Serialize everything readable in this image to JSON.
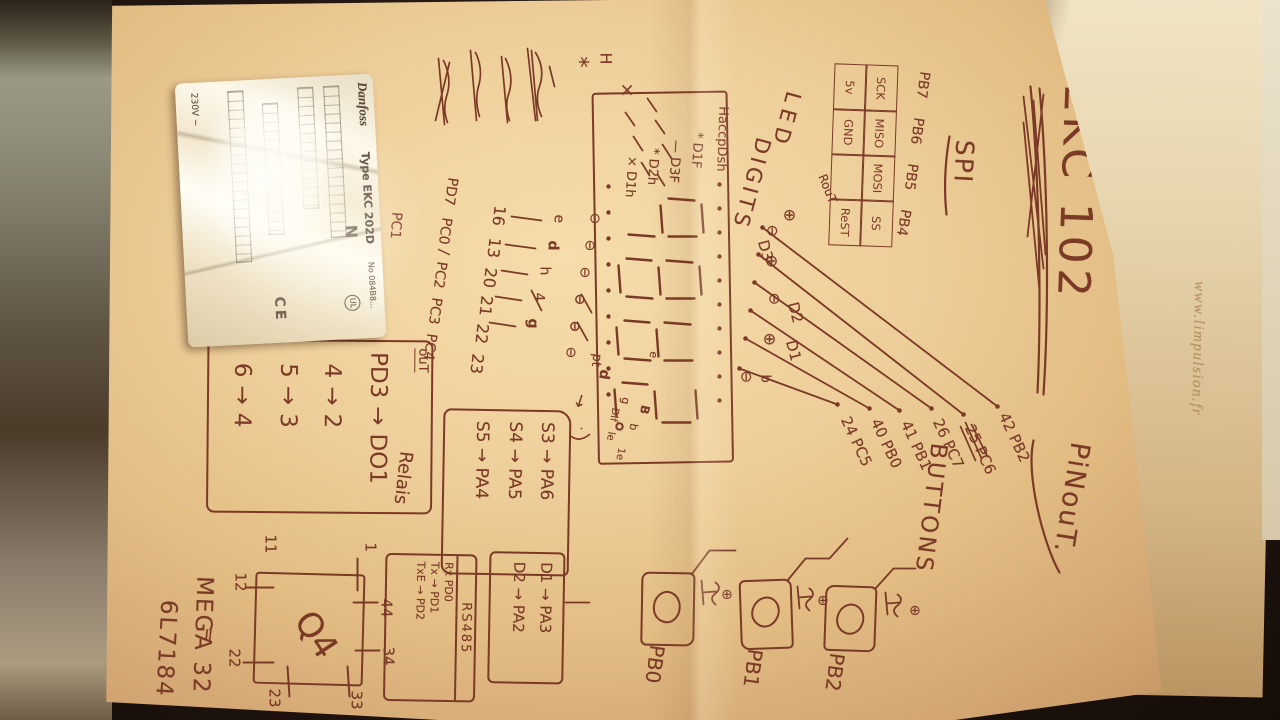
{
  "photo": {
    "watermark": "www.limpulsion.fr"
  },
  "page": {
    "title": "EKC 102",
    "subtitle": "PiNouT.",
    "chip": "MEGA 32",
    "code": "6L7184"
  },
  "icons": {
    "circled_plus": "⊕",
    "circled_minus": "⊖",
    "arrow": "→",
    "equals": "=",
    "x_mark": "×",
    "star": "*",
    "dash": "—"
  },
  "margin": {
    "h": "H",
    "star": "*",
    "x": "×"
  },
  "spi": {
    "label": "SPI",
    "port_labels": [
      "PB7",
      "PB6",
      "PB5",
      "PB4"
    ],
    "row1": [
      "SCK",
      "MISO",
      "MOSI",
      "SS"
    ],
    "row2": [
      "5v",
      "GND",
      "",
      "ReST"
    ],
    "note": "RouT"
  },
  "led": {
    "label_a": "LED",
    "label_b": "DIGITS",
    "header": "HaccpDsh",
    "legend": [
      "* D1F",
      "— D3F",
      "* D2h",
      "× D1h"
    ],
    "lamp_labels": [
      "D3",
      "D2",
      "D1",
      "b"
    ],
    "segment_notes": [
      "e",
      "B",
      "b",
      "g",
      "Dif",
      "le",
      "1e",
      "d"
    ],
    "pt": "pt"
  },
  "lamp_pins": [
    "42 PB2",
    "25 PC6",
    "26 PC7",
    "41 PB1",
    "40 PB0",
    "24 PC5"
  ],
  "seg_pins": {
    "letters": [
      "e",
      "d",
      "h",
      "4",
      "g"
    ],
    "numbers": [
      "16",
      "13",
      "20",
      "21",
      "22",
      "23"
    ],
    "ports": [
      "PD7",
      "PC0",
      "/",
      "PC2",
      "PC3",
      "PC4"
    ],
    "extra": "PC1"
  },
  "buttons": {
    "label": "BUTTONS",
    "items": [
      "PB2",
      "PB1",
      "PB0"
    ]
  },
  "keys_box": {
    "rows": [
      "S3 → PA6",
      "S4 → PA5",
      "S5 → PA4"
    ]
  },
  "out_box": {
    "header": "ouT",
    "side_label": "Relais",
    "rows": [
      [
        "PD3",
        "→",
        "DO1"
      ],
      [
        "4",
        "→",
        "2"
      ],
      [
        "5",
        "→",
        "3"
      ],
      [
        "6",
        "→",
        "4"
      ]
    ]
  },
  "display_box": {
    "rows": [
      "D1 → PA3",
      "D2 → PA2"
    ]
  },
  "rs485_box": {
    "header": "RS485",
    "rows": [
      "Rx PD0",
      "Tx → PD1",
      "TxE → PD2"
    ]
  },
  "terminal_box": {
    "label": "Q4",
    "eq": "=",
    "pins": {
      "p1": "1",
      "p44": "44",
      "p34": "34",
      "p33": "33",
      "p11": "11",
      "p12": "12",
      "p22": "22",
      "p23": "23"
    }
  },
  "sticker": {
    "brand": "Danfoss",
    "type": "Type EKC 202D",
    "code": "No 084B8...",
    "voltage": "230V ~",
    "ce": "CE",
    "ul": "UL",
    "n": "N"
  }
}
